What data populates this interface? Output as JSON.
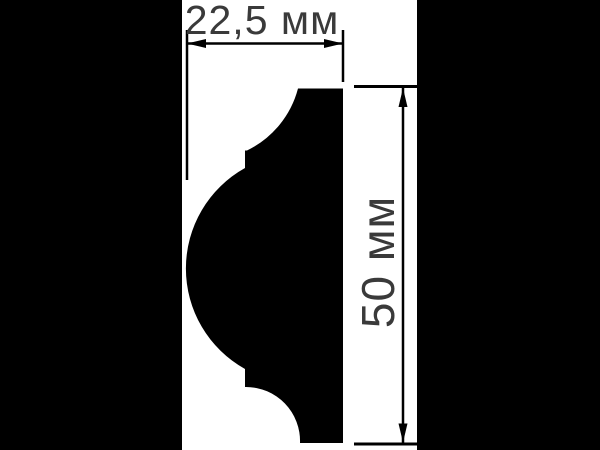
{
  "colors": {
    "background": "#ffffff",
    "side_panels": "#000000",
    "profile_silhouette": "#000000",
    "dimension_lines": "#000000",
    "dimension_text": "#3a3a3a"
  },
  "drawing": {
    "subject": "molding-profile-cross-section",
    "width_dimension": {
      "label": "22,5 мм",
      "value": "22,5",
      "unit": "мм"
    },
    "height_dimension": {
      "label": "50 мм",
      "value": "50",
      "unit": "мм"
    }
  }
}
